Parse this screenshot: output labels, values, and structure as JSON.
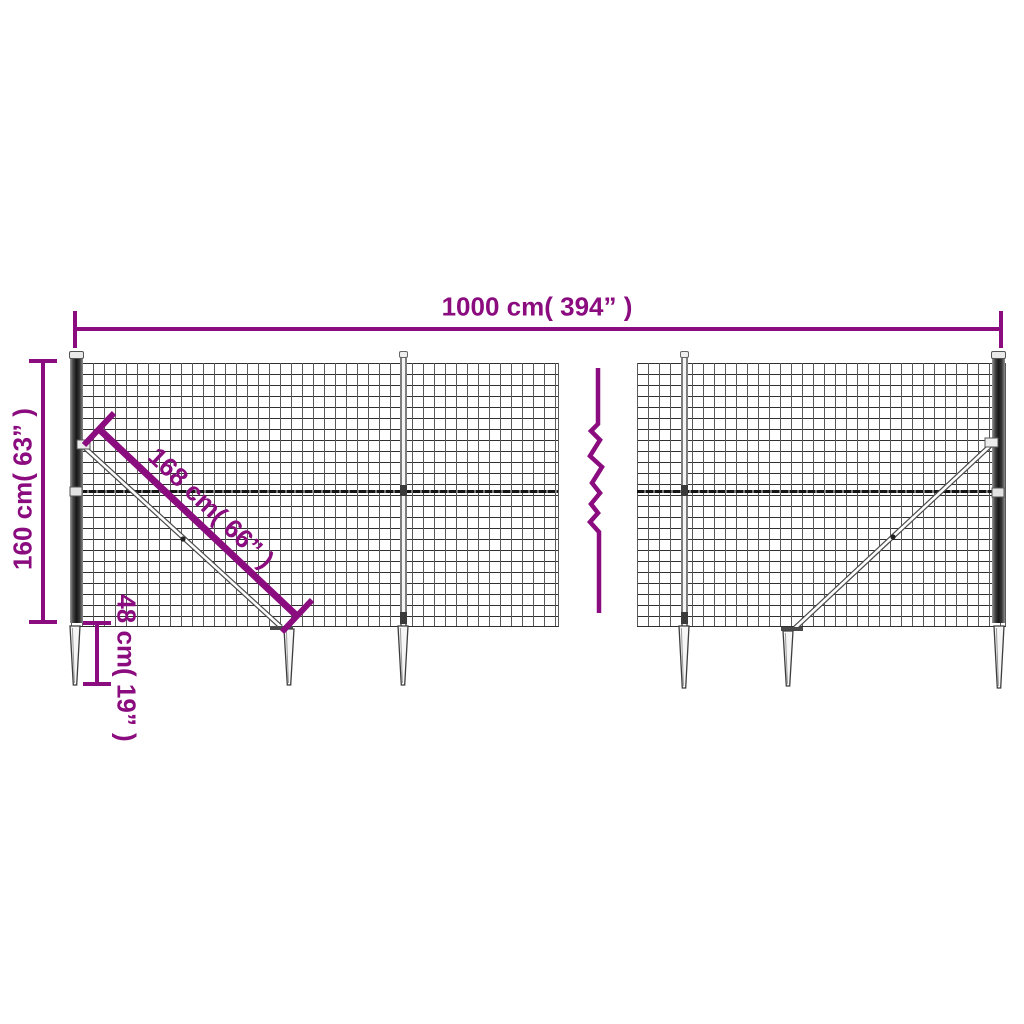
{
  "colors": {
    "accent": "#8a0c7e",
    "wire": "#3c3c3c"
  },
  "dimensions": {
    "width": {
      "label": "1000 cm( 394” )"
    },
    "height": {
      "label": "160 cm( 63” )"
    },
    "diagonal": {
      "label": "168 cm( 66” )"
    },
    "anchor_depth": {
      "label": "48 cm( 19” )"
    }
  }
}
